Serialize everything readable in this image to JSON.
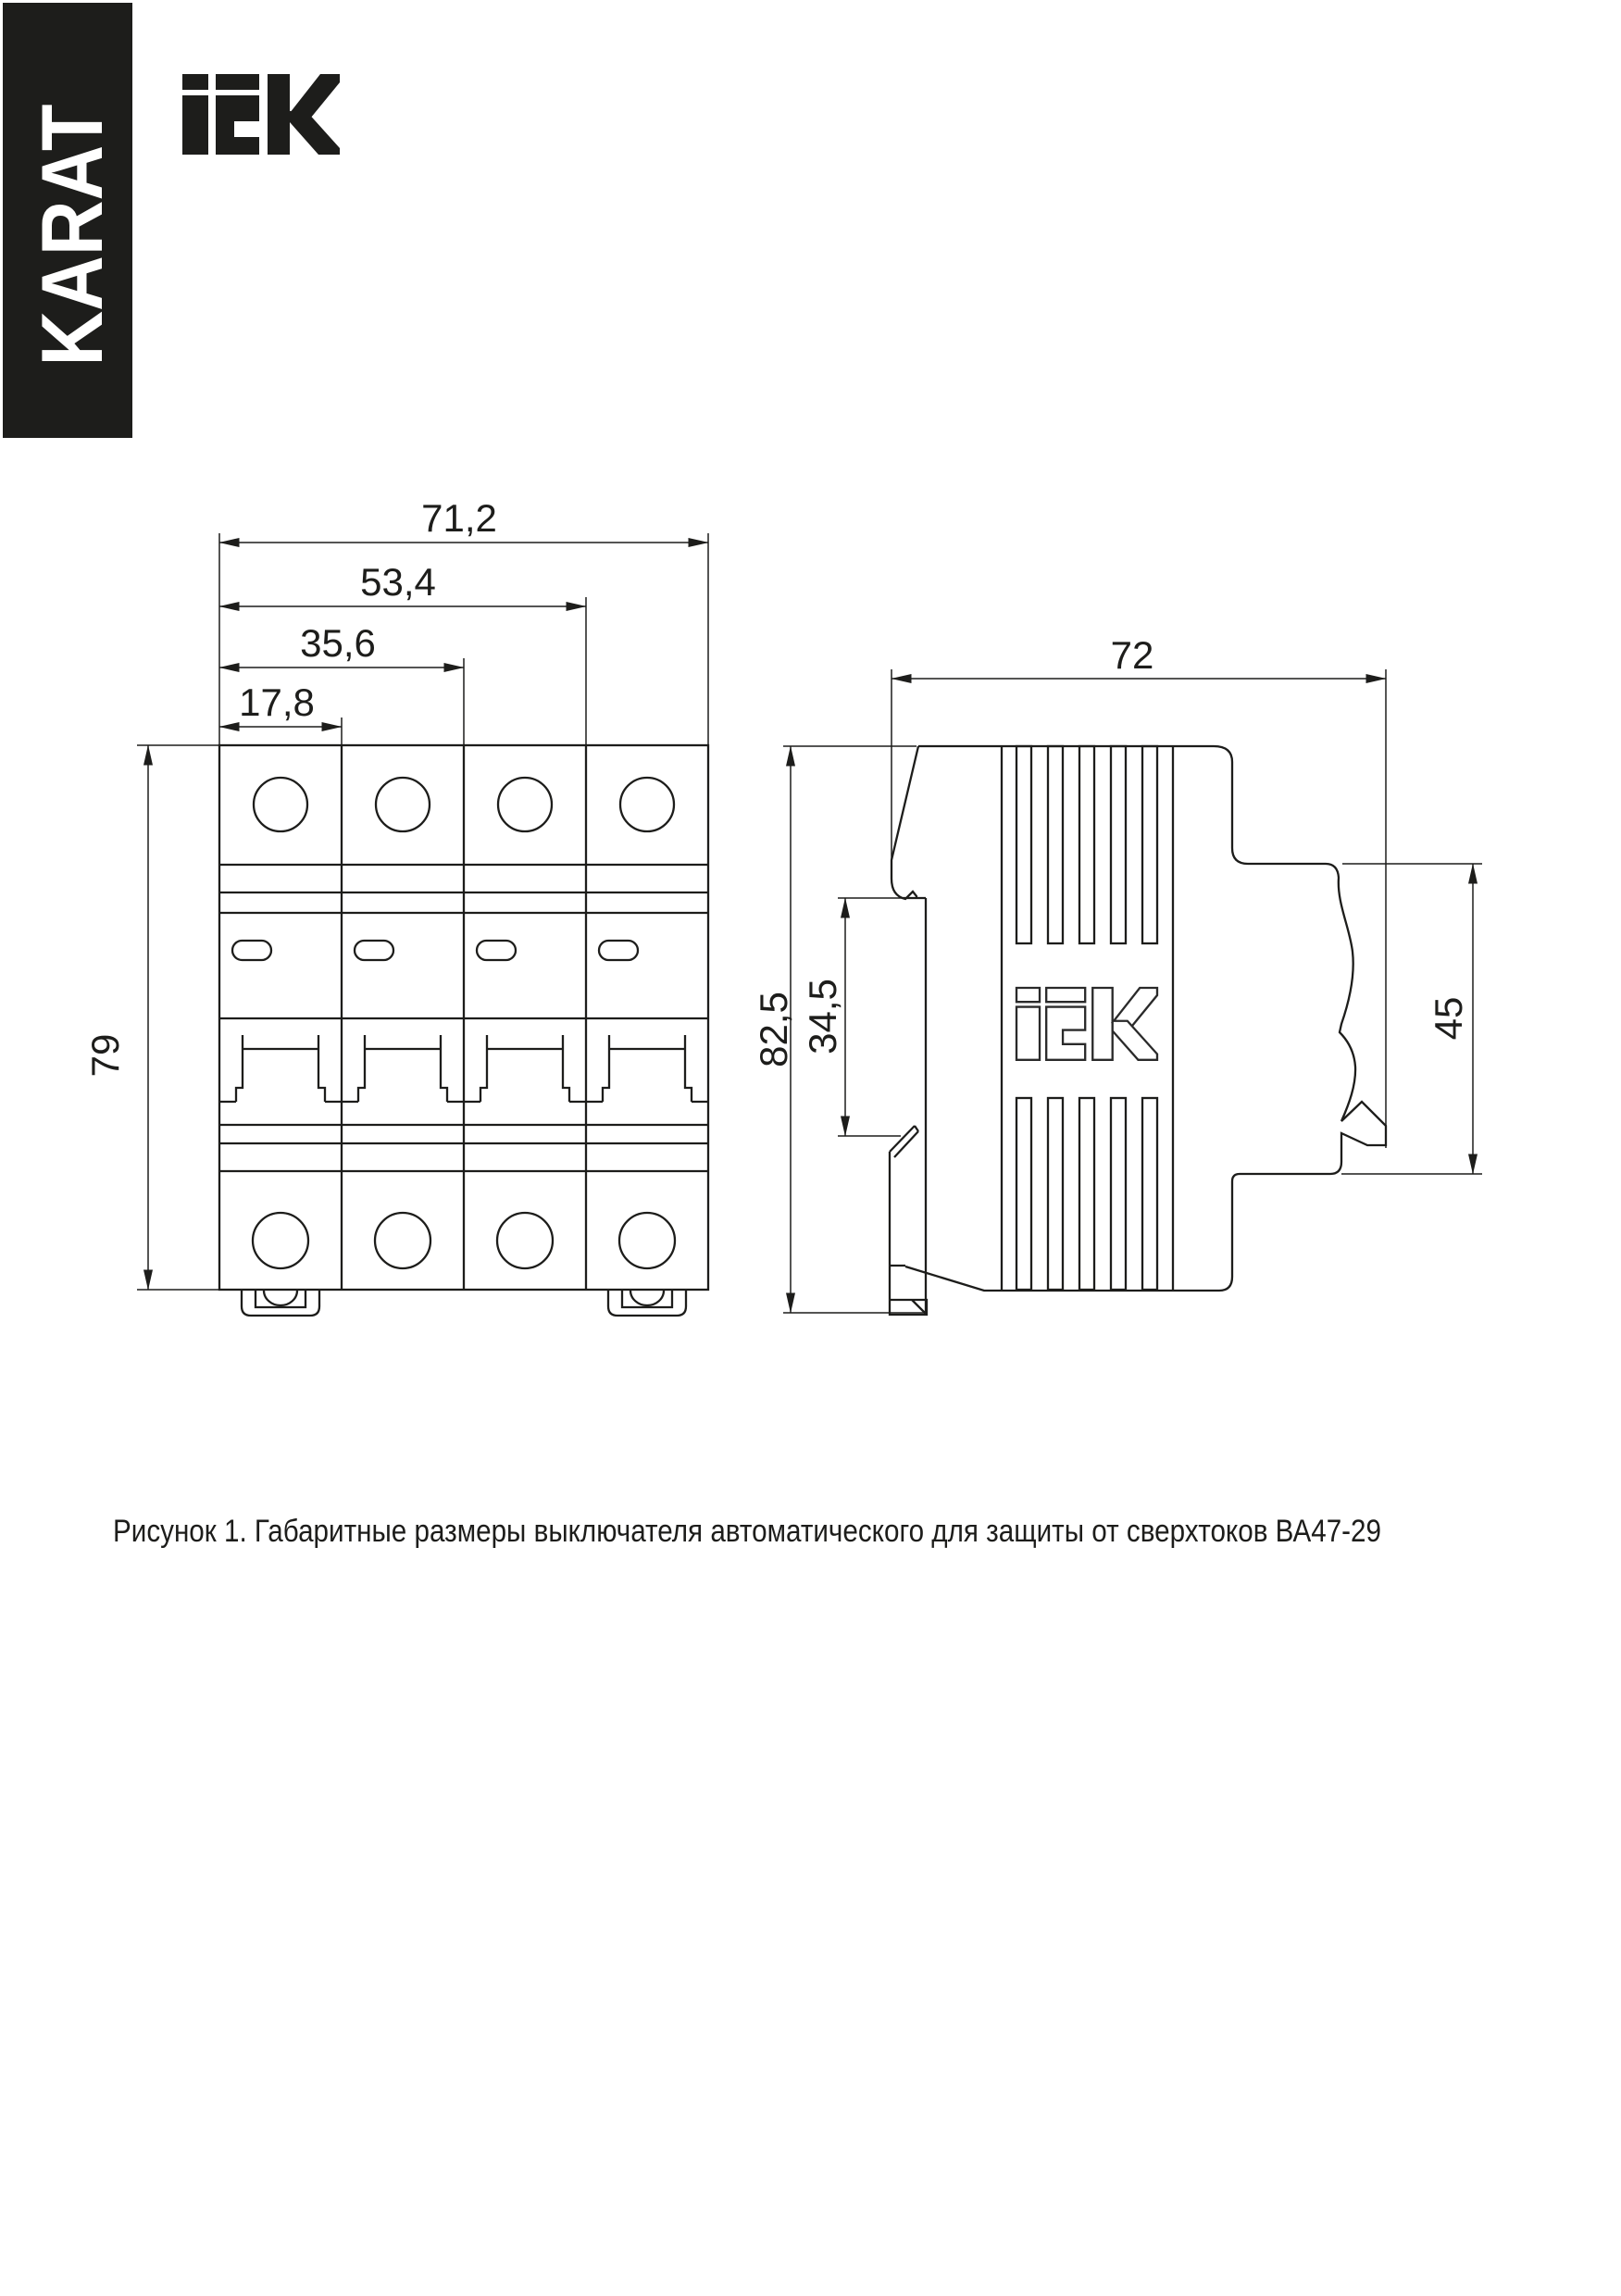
{
  "brand": {
    "karat_label": "KARAT",
    "iek_logo": "iEK"
  },
  "colors": {
    "ink": "#1d1d1b",
    "sidebar_bg": "#1d1d1b"
  },
  "drawing": {
    "front_view": {
      "width_dims": [
        "71,2",
        "53,4",
        "35,6",
        "17,8"
      ],
      "height_dim": "79"
    },
    "side_view": {
      "width_dim": "72",
      "height_dim": "82,5",
      "rail_recess_dim": "34,5",
      "front_face_dim": "45"
    },
    "caption": "Рисунок 1. Габаритные размеры выключателя автоматического для защиты от сверхтоков ВА47-29"
  }
}
